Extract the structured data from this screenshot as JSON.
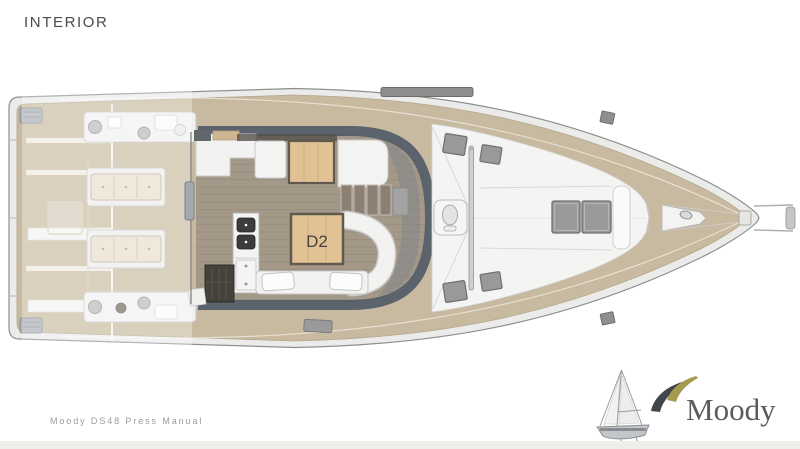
{
  "page": {
    "title": "INTERIOR",
    "footer_caption": "Moody DS48 Press Manual"
  },
  "plan": {
    "cabin_label": "D2"
  },
  "logo": {
    "brand": "Moody",
    "icons": {
      "sailboat": "sailboat-icon",
      "swoosh": "moody-swoosh-icon"
    }
  },
  "colors": {
    "hull": "#ebebea",
    "teak_deck": "#c8baa0",
    "window_band": "#515c68",
    "wood_table": "#e2c294",
    "logo_olive": "#a59a4e",
    "logo_gray": "#42464b"
  }
}
